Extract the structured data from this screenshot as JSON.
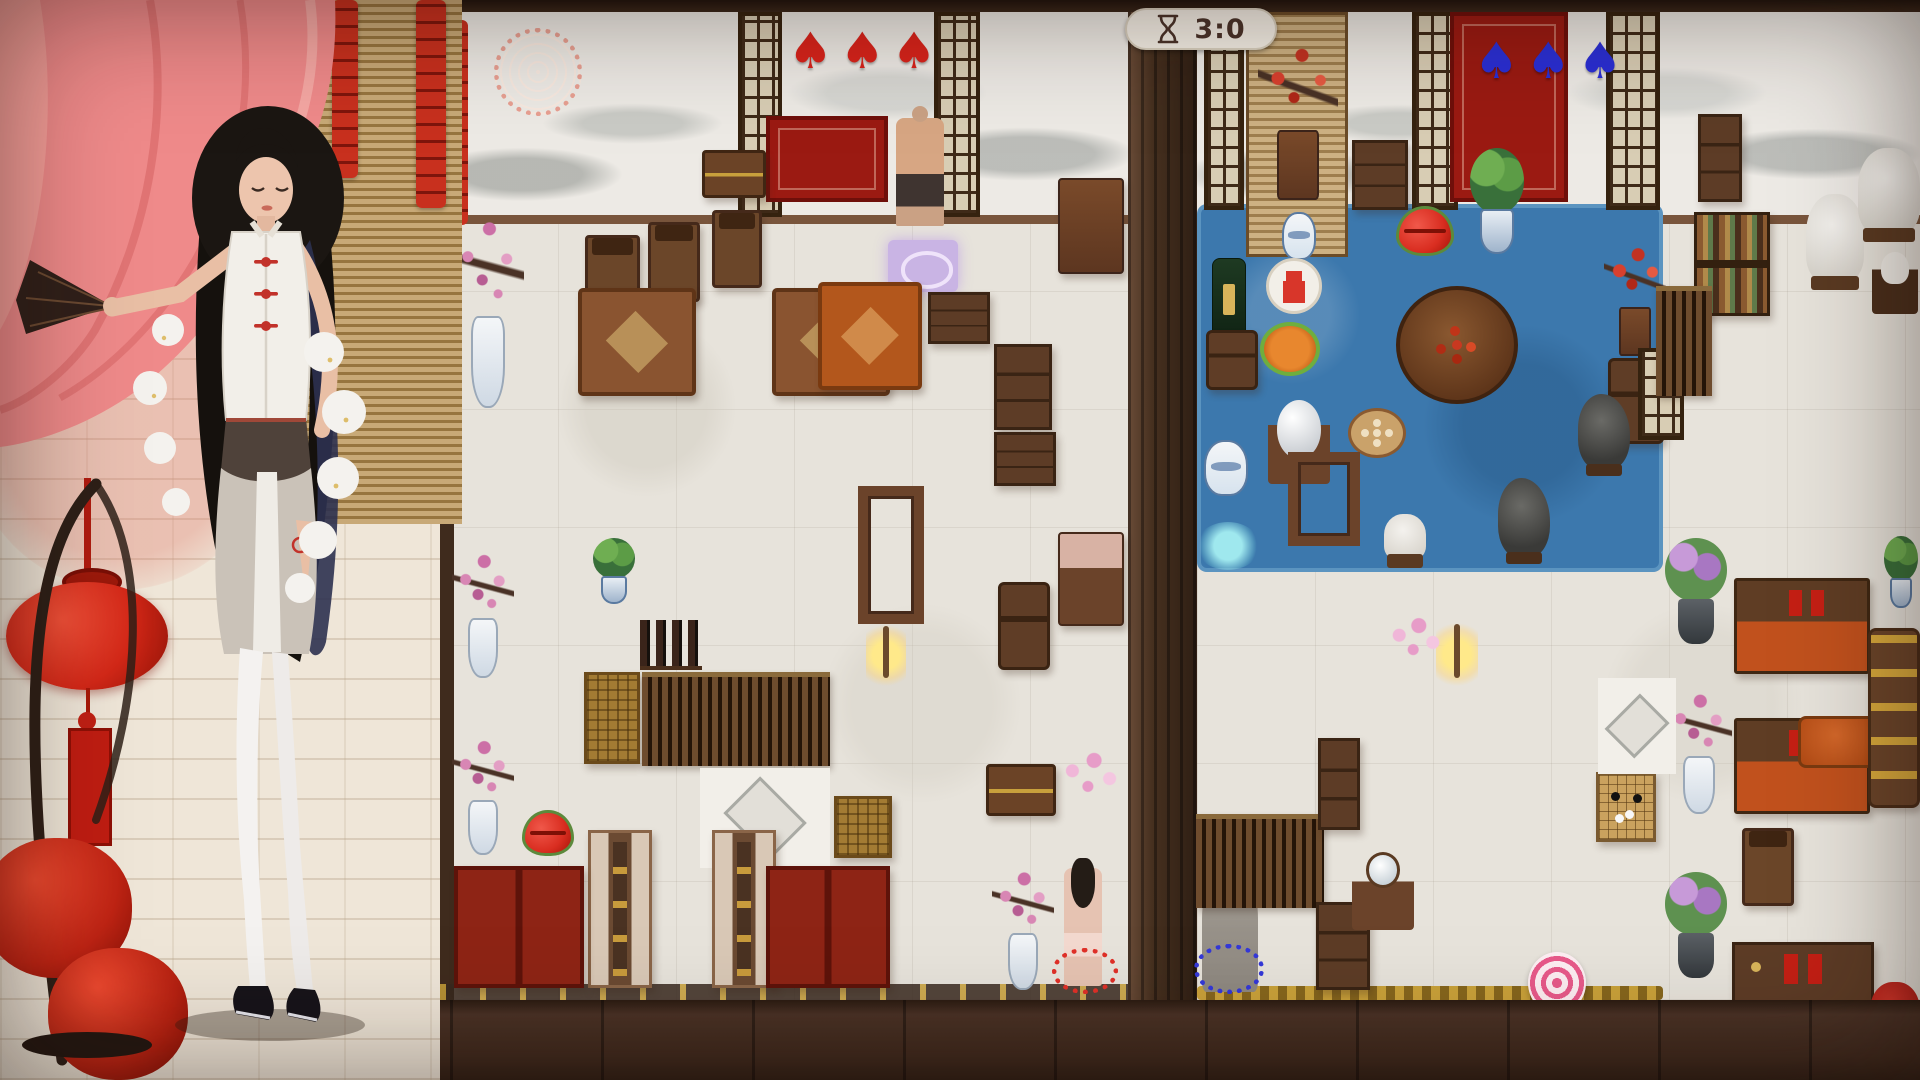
{
  "hud": {
    "timer": {
      "icon": "hourglass-icon",
      "value": "3:0"
    },
    "left_board_suits": {
      "name": "red-spade",
      "symbol": "♠",
      "count": 3,
      "color": "#d9231b"
    },
    "right_board_suits": {
      "name": "blue-spade",
      "symbol": "♠",
      "count": 3,
      "color": "#2a2fd6"
    }
  },
  "palette": {
    "pool_blue": "#3c78ad",
    "curtain_pink": "#ef8a8a",
    "lantern_red": "#d92c18",
    "timer_text": "#4a332a",
    "floor_wood": "#4a3226"
  },
  "boards": {
    "left": {
      "name": "left-room-board",
      "items": [
        {
          "name": "red-medallion",
          "type": "medallion",
          "x": 494,
          "y": 28,
          "w": 88,
          "h": 88
        },
        {
          "name": "firecracker-string-board",
          "type": "firecracker",
          "x": 446,
          "y": 20,
          "w": 22,
          "h": 205
        },
        {
          "name": "lattice-door-1",
          "type": "lattice",
          "x": 738,
          "y": 12,
          "w": 44,
          "h": 205
        },
        {
          "name": "lattice-door-2",
          "type": "lattice",
          "x": 934,
          "y": 12,
          "w": 46,
          "h": 205
        },
        {
          "name": "red-rug-top",
          "type": "rug-red",
          "x": 766,
          "y": 116,
          "w": 122,
          "h": 86
        },
        {
          "name": "man-figure",
          "type": "person-man",
          "x": 896,
          "y": 118,
          "w": 48,
          "h": 108
        },
        {
          "name": "storage-chest",
          "type": "chest",
          "x": 702,
          "y": 150,
          "w": 64,
          "h": 48
        },
        {
          "name": "tall-chair-1",
          "type": "chair",
          "x": 585,
          "y": 235,
          "w": 55,
          "h": 85
        },
        {
          "name": "tall-chair-2",
          "type": "chair",
          "x": 648,
          "y": 222,
          "w": 52,
          "h": 80
        },
        {
          "name": "tall-chair-3",
          "type": "chair",
          "x": 712,
          "y": 210,
          "w": 50,
          "h": 78
        },
        {
          "name": "armchair-1",
          "type": "armchair",
          "x": 578,
          "y": 288,
          "w": 118,
          "h": 108
        },
        {
          "name": "armchair-2",
          "type": "armchair",
          "x": 772,
          "y": 288,
          "w": 118,
          "h": 108
        },
        {
          "name": "eye-tile",
          "type": "eye",
          "x": 888,
          "y": 240,
          "w": 70,
          "h": 52
        },
        {
          "name": "orange-armchair",
          "type": "armchair-orange",
          "x": 818,
          "y": 282,
          "w": 104,
          "h": 108
        },
        {
          "name": "plum-vase-1",
          "type": "plum",
          "x": 452,
          "y": 208,
          "w": 72,
          "h": 200
        },
        {
          "name": "plum-vase-2",
          "type": "plum",
          "x": 452,
          "y": 548,
          "w": 62,
          "h": 130
        },
        {
          "name": "plum-vase-3",
          "type": "plum",
          "x": 452,
          "y": 735,
          "w": 62,
          "h": 120
        },
        {
          "name": "desk-1",
          "type": "cabinet",
          "x": 928,
          "y": 292,
          "w": 62,
          "h": 52
        },
        {
          "name": "cabinet-1",
          "type": "cabinet",
          "x": 994,
          "y": 344,
          "w": 58,
          "h": 86
        },
        {
          "name": "cabinet-2",
          "type": "cabinet",
          "x": 994,
          "y": 432,
          "w": 62,
          "h": 54
        },
        {
          "name": "side-table-top",
          "type": "table",
          "x": 1058,
          "y": 178,
          "w": 66,
          "h": 96
        },
        {
          "name": "frame-table-1",
          "type": "frame-table",
          "x": 858,
          "y": 486,
          "w": 66,
          "h": 138
        },
        {
          "name": "stool-1",
          "type": "stool",
          "x": 998,
          "y": 582,
          "w": 52,
          "h": 88
        },
        {
          "name": "pink-table",
          "type": "table-pink",
          "x": 1058,
          "y": 532,
          "w": 66,
          "h": 94
        },
        {
          "name": "lamp-left",
          "type": "lamp",
          "x": 866,
          "y": 618,
          "w": 40,
          "h": 68
        },
        {
          "name": "wine-bottles",
          "type": "bottles",
          "x": 640,
          "y": 620,
          "w": 62,
          "h": 50
        },
        {
          "name": "gold-cabinet-1",
          "type": "gold-chest",
          "x": 584,
          "y": 672,
          "w": 56,
          "h": 92
        },
        {
          "name": "screen-wide",
          "type": "screen-stripes",
          "x": 642,
          "y": 672,
          "w": 188,
          "h": 94
        },
        {
          "name": "bamboo-pot",
          "type": "plant",
          "x": 590,
          "y": 538,
          "w": 48,
          "h": 66
        },
        {
          "name": "lips-left",
          "type": "lips",
          "x": 522,
          "y": 810,
          "w": 52,
          "h": 46
        },
        {
          "name": "diamond-floor-left",
          "type": "diamond-floor",
          "x": 700,
          "y": 768,
          "w": 130,
          "h": 100
        },
        {
          "name": "gold-cabinet-2",
          "type": "gold-chest",
          "x": 834,
          "y": 796,
          "w": 58,
          "h": 62
        },
        {
          "name": "bed-1",
          "type": "bed",
          "x": 588,
          "y": 830,
          "w": 64,
          "h": 158
        },
        {
          "name": "bed-2",
          "type": "bed",
          "x": 712,
          "y": 830,
          "w": 64,
          "h": 158
        },
        {
          "name": "red-cabinet-1",
          "type": "red-cabinet",
          "x": 454,
          "y": 866,
          "w": 130,
          "h": 122
        },
        {
          "name": "red-cabinet-2",
          "type": "red-cabinet",
          "x": 766,
          "y": 866,
          "w": 124,
          "h": 122
        },
        {
          "name": "wood-chest-2",
          "type": "chest",
          "x": 986,
          "y": 764,
          "w": 70,
          "h": 52
        },
        {
          "name": "petals-pink-left",
          "type": "petals-pink",
          "x": 1060,
          "y": 750,
          "w": 62,
          "h": 52
        },
        {
          "name": "plum-cabinet",
          "type": "plum",
          "x": 992,
          "y": 866,
          "w": 62,
          "h": 124
        },
        {
          "name": "girl-figure",
          "type": "person-girl",
          "x": 1064,
          "y": 868,
          "w": 38,
          "h": 118
        },
        {
          "name": "petal-ring-red",
          "type": "petals-red",
          "x": 1052,
          "y": 948,
          "w": 66,
          "h": 46
        }
      ]
    },
    "right": {
      "name": "right-room-board",
      "items": [
        {
          "name": "lattice-door-3",
          "type": "lattice",
          "x": 1204,
          "y": 12,
          "w": 40,
          "h": 198
        },
        {
          "name": "bamboo-blind-right",
          "type": "blind",
          "x": 1246,
          "y": 12,
          "w": 102,
          "h": 245
        },
        {
          "name": "plum-branch-red",
          "type": "plum-red",
          "x": 1258,
          "y": 40,
          "w": 80,
          "h": 160
        },
        {
          "name": "lattice-door-4",
          "type": "lattice",
          "x": 1412,
          "y": 12,
          "w": 46,
          "h": 198
        },
        {
          "name": "red-rug-right",
          "type": "rug-red",
          "x": 1450,
          "y": 12,
          "w": 118,
          "h": 190
        },
        {
          "name": "plant-pot",
          "type": "plant",
          "x": 1466,
          "y": 148,
          "w": 62,
          "h": 106
        },
        {
          "name": "lattice-door-5",
          "type": "lattice",
          "x": 1606,
          "y": 12,
          "w": 54,
          "h": 198
        },
        {
          "name": "cabinet-small-top",
          "type": "cabinet",
          "x": 1352,
          "y": 140,
          "w": 56,
          "h": 70
        },
        {
          "name": "lips-right",
          "type": "lips",
          "x": 1396,
          "y": 206,
          "w": 58,
          "h": 50
        },
        {
          "name": "white-vase",
          "type": "jar",
          "x": 1282,
          "y": 212,
          "w": 34,
          "h": 48
        },
        {
          "name": "gourd-medal",
          "type": "medal-gourd",
          "x": 1266,
          "y": 258,
          "w": 56,
          "h": 56
        },
        {
          "name": "champagne",
          "type": "bottle",
          "x": 1212,
          "y": 258,
          "w": 34,
          "h": 92
        },
        {
          "name": "champagne-table",
          "type": "stool",
          "x": 1206,
          "y": 330,
          "w": 52,
          "h": 60
        },
        {
          "name": "mooncake-plate",
          "type": "plate-orange",
          "x": 1260,
          "y": 322,
          "w": 60,
          "h": 54
        },
        {
          "name": "round-table-food",
          "type": "round-table",
          "x": 1396,
          "y": 286,
          "w": 122,
          "h": 118
        },
        {
          "name": "ball-table",
          "type": "ball",
          "x": 1268,
          "y": 400,
          "w": 62,
          "h": 84
        },
        {
          "name": "dimsum-plate",
          "type": "plate-dimsum",
          "x": 1348,
          "y": 408,
          "w": 58,
          "h": 50
        },
        {
          "name": "jar-blue",
          "type": "jar",
          "x": 1204,
          "y": 440,
          "w": 44,
          "h": 56
        },
        {
          "name": "frame-table-3",
          "type": "frame-table",
          "x": 1288,
          "y": 452,
          "w": 72,
          "h": 94
        },
        {
          "name": "flower-table",
          "type": "plum-red",
          "x": 1604,
          "y": 244,
          "w": 62,
          "h": 112
        },
        {
          "name": "stool-2",
          "type": "stool",
          "x": 1608,
          "y": 358,
          "w": 56,
          "h": 86
        },
        {
          "name": "bonsai-dark",
          "type": "bonsai",
          "x": 1578,
          "y": 394,
          "w": 52,
          "h": 76
        },
        {
          "name": "rock-sculpture",
          "type": "bonsai",
          "x": 1498,
          "y": 478,
          "w": 52,
          "h": 80
        },
        {
          "name": "horse-small",
          "type": "horse",
          "x": 1384,
          "y": 514,
          "w": 42,
          "h": 46
        },
        {
          "name": "lattice-screen-small",
          "type": "lattice",
          "x": 1638,
          "y": 348,
          "w": 46,
          "h": 92
        },
        {
          "name": "cabinet-top-right",
          "type": "cabinet",
          "x": 1698,
          "y": 114,
          "w": 44,
          "h": 88
        },
        {
          "name": "bookshelf",
          "type": "bookshelf",
          "x": 1694,
          "y": 212,
          "w": 76,
          "h": 104
        },
        {
          "name": "horse-statue",
          "type": "horse",
          "x": 1806,
          "y": 194,
          "w": 58,
          "h": 88
        },
        {
          "name": "white-armchair",
          "type": "horse",
          "x": 1858,
          "y": 148,
          "w": 62,
          "h": 86
        },
        {
          "name": "teapot-table",
          "type": "teapot",
          "x": 1872,
          "y": 252,
          "w": 46,
          "h": 62
        },
        {
          "name": "screen-stripes-right",
          "type": "screen-stripes",
          "x": 1656,
          "y": 286,
          "w": 56,
          "h": 110
        },
        {
          "name": "lamp-right",
          "type": "lamp",
          "x": 1436,
          "y": 616,
          "w": 42,
          "h": 70
        },
        {
          "name": "petals-pink-right",
          "type": "petals-pink",
          "x": 1388,
          "y": 616,
          "w": 56,
          "h": 48
        },
        {
          "name": "splash-cyan",
          "type": "splash",
          "x": 1196,
          "y": 522,
          "w": 64,
          "h": 48
        },
        {
          "name": "purple-plant-1",
          "type": "plant-purple",
          "x": 1662,
          "y": 538,
          "w": 68,
          "h": 106
        },
        {
          "name": "purple-plant-2",
          "type": "plant-purple",
          "x": 1662,
          "y": 872,
          "w": 68,
          "h": 106
        },
        {
          "name": "daybed-1",
          "type": "daybed",
          "x": 1734,
          "y": 578,
          "w": 136,
          "h": 96
        },
        {
          "name": "daybed-2",
          "type": "daybed",
          "x": 1734,
          "y": 718,
          "w": 136,
          "h": 96
        },
        {
          "name": "orange-ottoman",
          "type": "couch-orange",
          "x": 1798,
          "y": 716,
          "w": 92,
          "h": 52
        },
        {
          "name": "go-board",
          "type": "go-board",
          "x": 1596,
          "y": 772,
          "w": 60,
          "h": 70
        },
        {
          "name": "plum-table-mid",
          "type": "plum",
          "x": 1666,
          "y": 688,
          "w": 66,
          "h": 126
        },
        {
          "name": "tall-chair-4",
          "type": "chair",
          "x": 1742,
          "y": 828,
          "w": 52,
          "h": 78
        },
        {
          "name": "shelf-bottom",
          "type": "shelf-tags",
          "x": 1732,
          "y": 942,
          "w": 142,
          "h": 62
        },
        {
          "name": "bamboo-top-right",
          "type": "plant",
          "x": 1882,
          "y": 536,
          "w": 38,
          "h": 72
        },
        {
          "name": "red-cushion-corner",
          "type": "red-cushion",
          "x": 1870,
          "y": 982,
          "w": 50,
          "h": 62
        },
        {
          "name": "couch-yellow",
          "type": "couch-yellow",
          "x": 1868,
          "y": 628,
          "w": 52,
          "h": 180
        },
        {
          "name": "robed-figure",
          "type": "person-robed",
          "x": 1202,
          "y": 860,
          "w": 56,
          "h": 132
        },
        {
          "name": "petal-ring-blue",
          "type": "petals-blue",
          "x": 1194,
          "y": 944,
          "w": 70,
          "h": 50
        },
        {
          "name": "abacus-screen",
          "type": "screen-stripes",
          "x": 1196,
          "y": 814,
          "w": 128,
          "h": 94
        },
        {
          "name": "cabinet-right-1",
          "type": "cabinet",
          "x": 1318,
          "y": 738,
          "w": 42,
          "h": 92
        },
        {
          "name": "cabinet-right-2",
          "type": "cabinet",
          "x": 1316,
          "y": 902,
          "w": 54,
          "h": 88
        },
        {
          "name": "swirl-candy",
          "type": "swirl",
          "x": 1528,
          "y": 952,
          "w": 58,
          "h": 62
        },
        {
          "name": "mirror-table",
          "type": "mirror",
          "x": 1352,
          "y": 852,
          "w": 62,
          "h": 78
        },
        {
          "name": "diamond-floor-right",
          "type": "diamond-floor",
          "x": 1598,
          "y": 678,
          "w": 78,
          "h": 96
        }
      ]
    }
  }
}
